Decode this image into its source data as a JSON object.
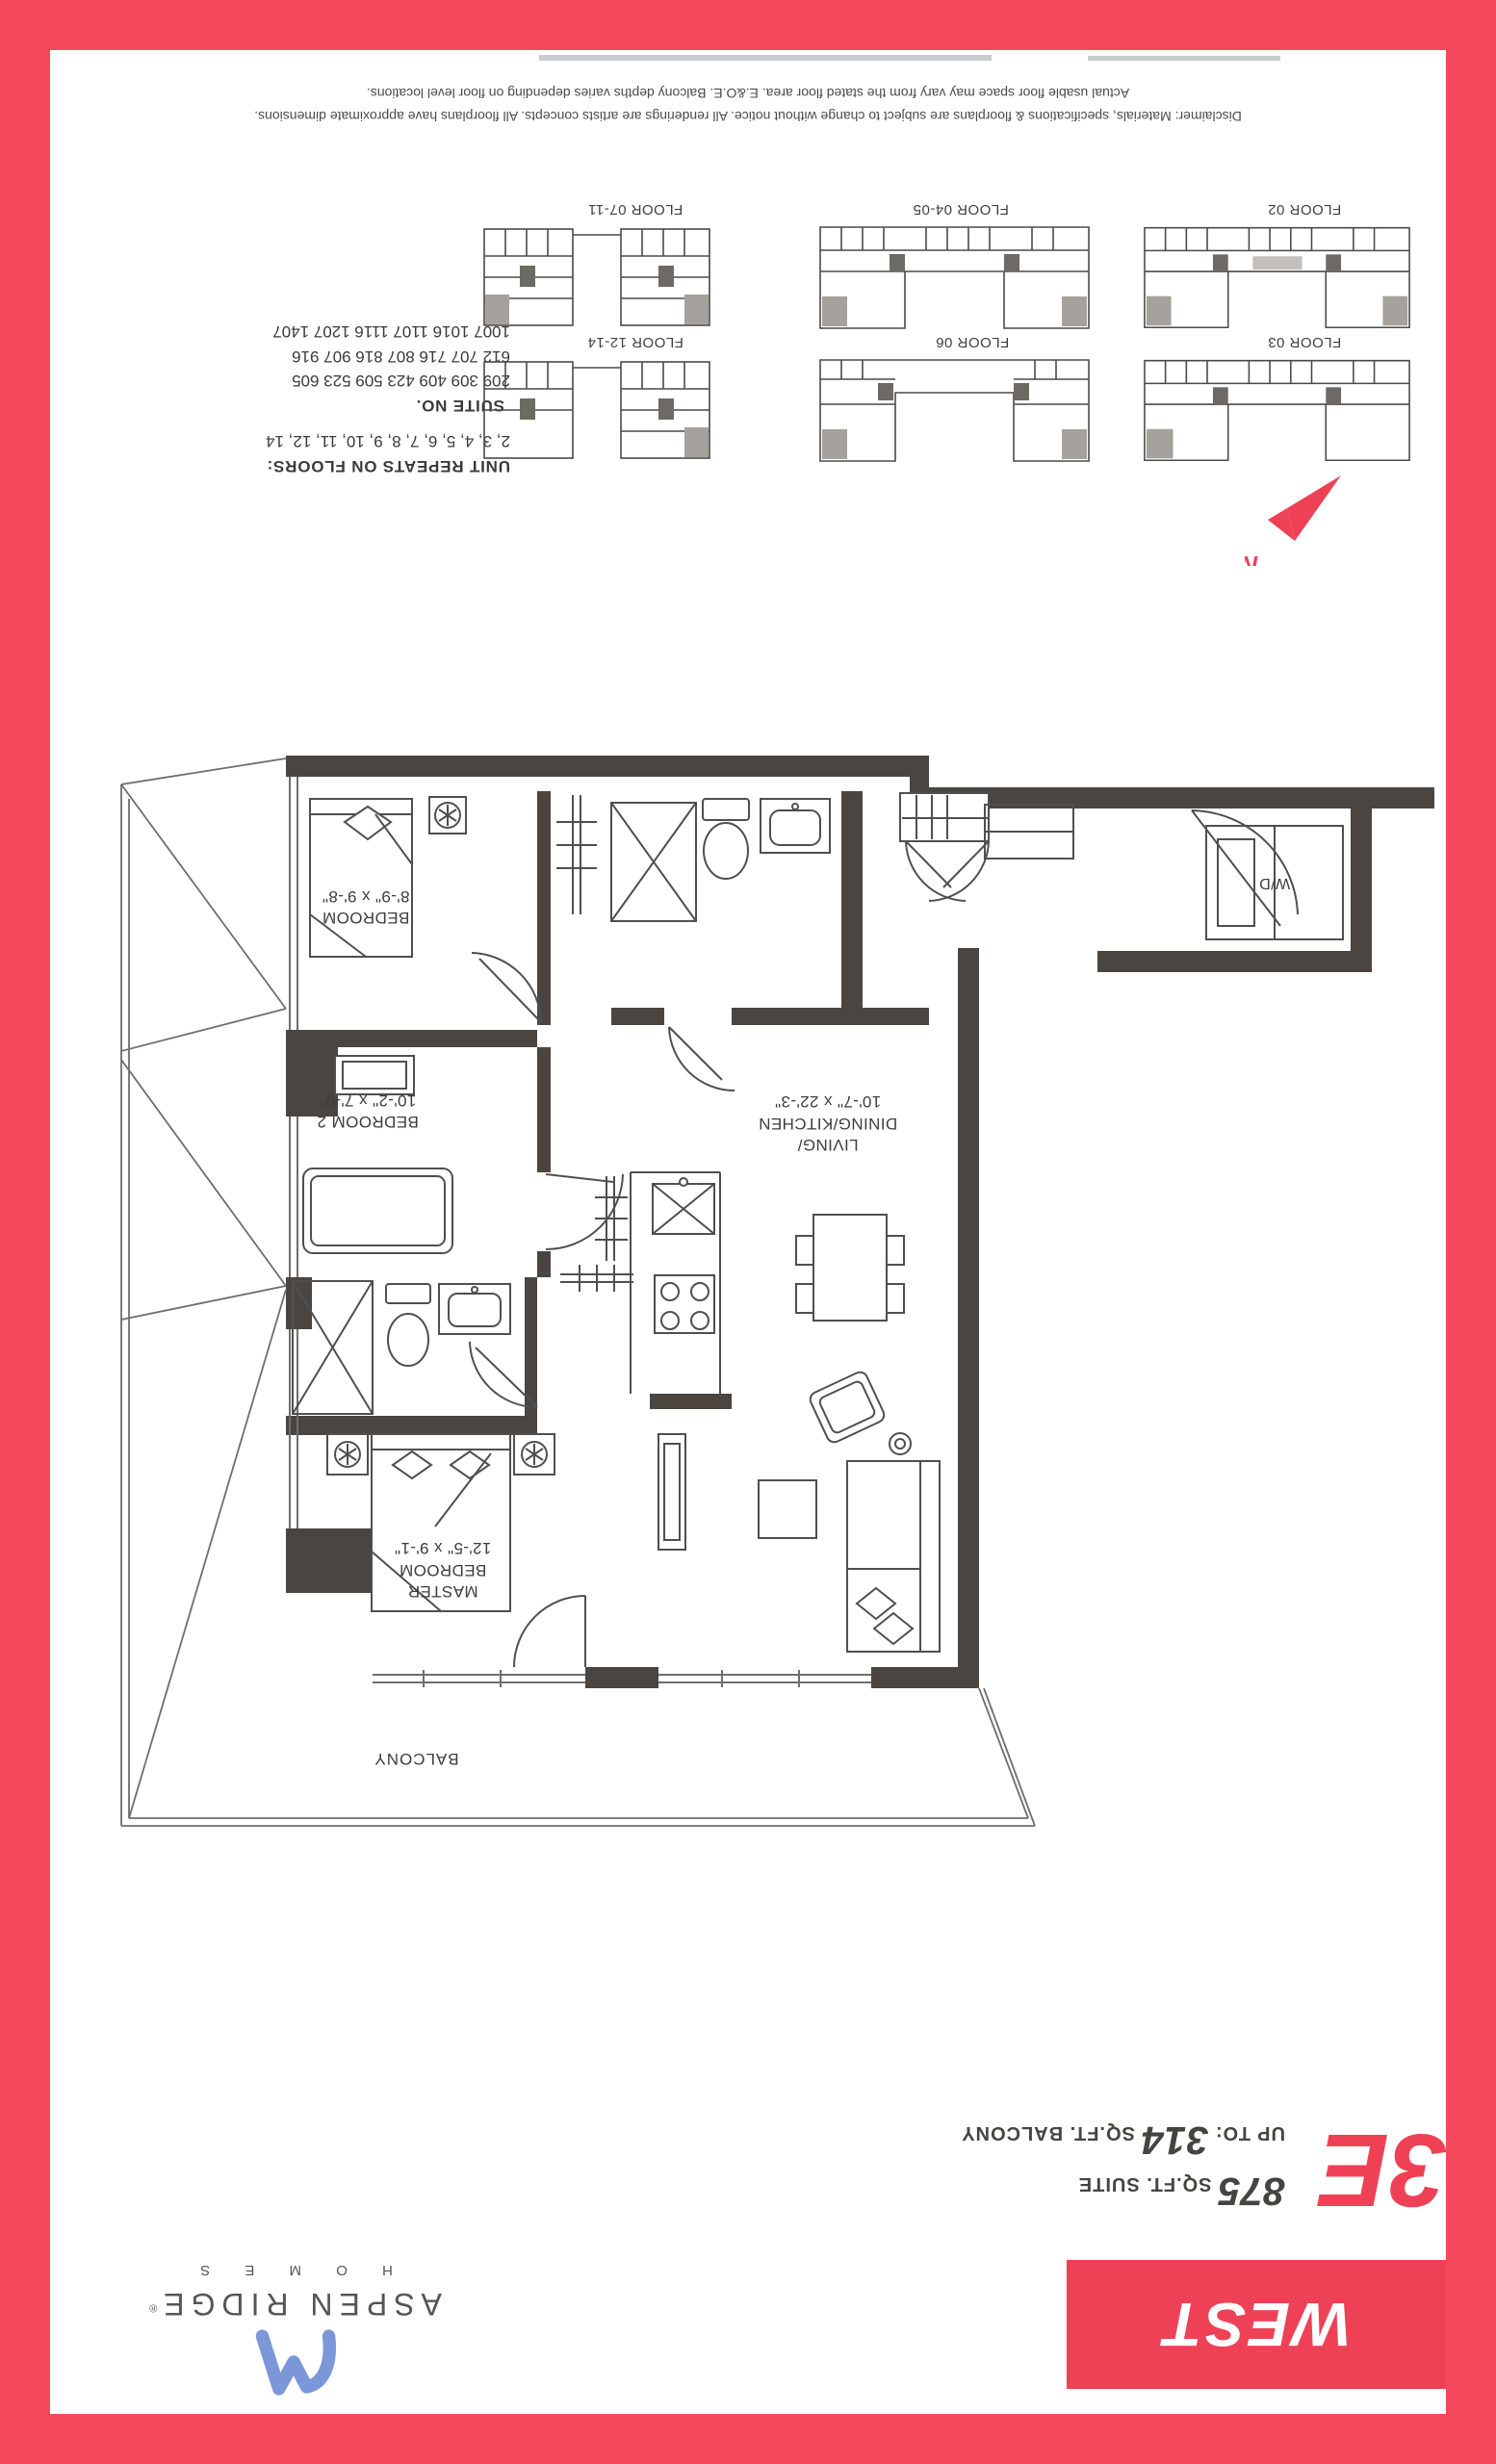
{
  "colors": {
    "frame_red": "#f4495c",
    "accent_red": "#ee4156",
    "wall_dark": "#4b4541",
    "logo_blue": "#7b97d9"
  },
  "disclaimer": {
    "line1": "Disclaimer: Materials, specifications & floorplans are subject to change without notice. All renderings are artists concepts. All floorplans have approximate dimensions.",
    "line2": "Actual usable floor space may vary from the stated floor area. E.&O.E. Balcony depths varies depending on floor level locations."
  },
  "key_plans": {
    "unit_repeats_heading": "UNIT REPEATS ON FLOORS:",
    "unit_repeats": "2, 3, 4, 5, 6, 7, 8, 9, 10, 11, 12, 14",
    "suite_heading": "SUITE NO.",
    "suite_lines": [
      "209 309 409 423 509 523 605",
      "612 707 716 807 816 907 916",
      "1007 1016 1107 1116 1207 1407"
    ],
    "labels": [
      "FLOOR 07-11",
      "FLOOR 04-05",
      "FLOOR 02",
      "FLOOR 12-14",
      "FLOOR 06",
      "FLOOR 03"
    ],
    "north_label": "N"
  },
  "floor_plan": {
    "bedroom": {
      "name": "BEDROOM",
      "dims": "8'-9\" x 9'-8\""
    },
    "bedroom2": {
      "name": "BEDROOM 2",
      "dims": "10'-2\" x 7'-0\""
    },
    "living": {
      "name1": "LIVING/",
      "name2": "DINING/KITCHEN",
      "dims": "10'-7\" x 22'-3\""
    },
    "master": {
      "name1": "MASTER",
      "name2": "BEDROOM",
      "dims": "12'-5\" x 9'-1\""
    },
    "balcony_label": "BALCONY",
    "wd_label": "W/D"
  },
  "suite_info": {
    "unit_code": "3E",
    "suite_value": "875",
    "suite_label": " SQ.FT. SUITE",
    "balcony_prefix": "UP TO: ",
    "balcony_value": "314",
    "balcony_label": " SQ.FT. BALCONY"
  },
  "branding": {
    "building_name": "WEST",
    "developer_name": "ASPEN RIDGE",
    "registered_mark": "®",
    "developer_sub": "H O M E S"
  }
}
